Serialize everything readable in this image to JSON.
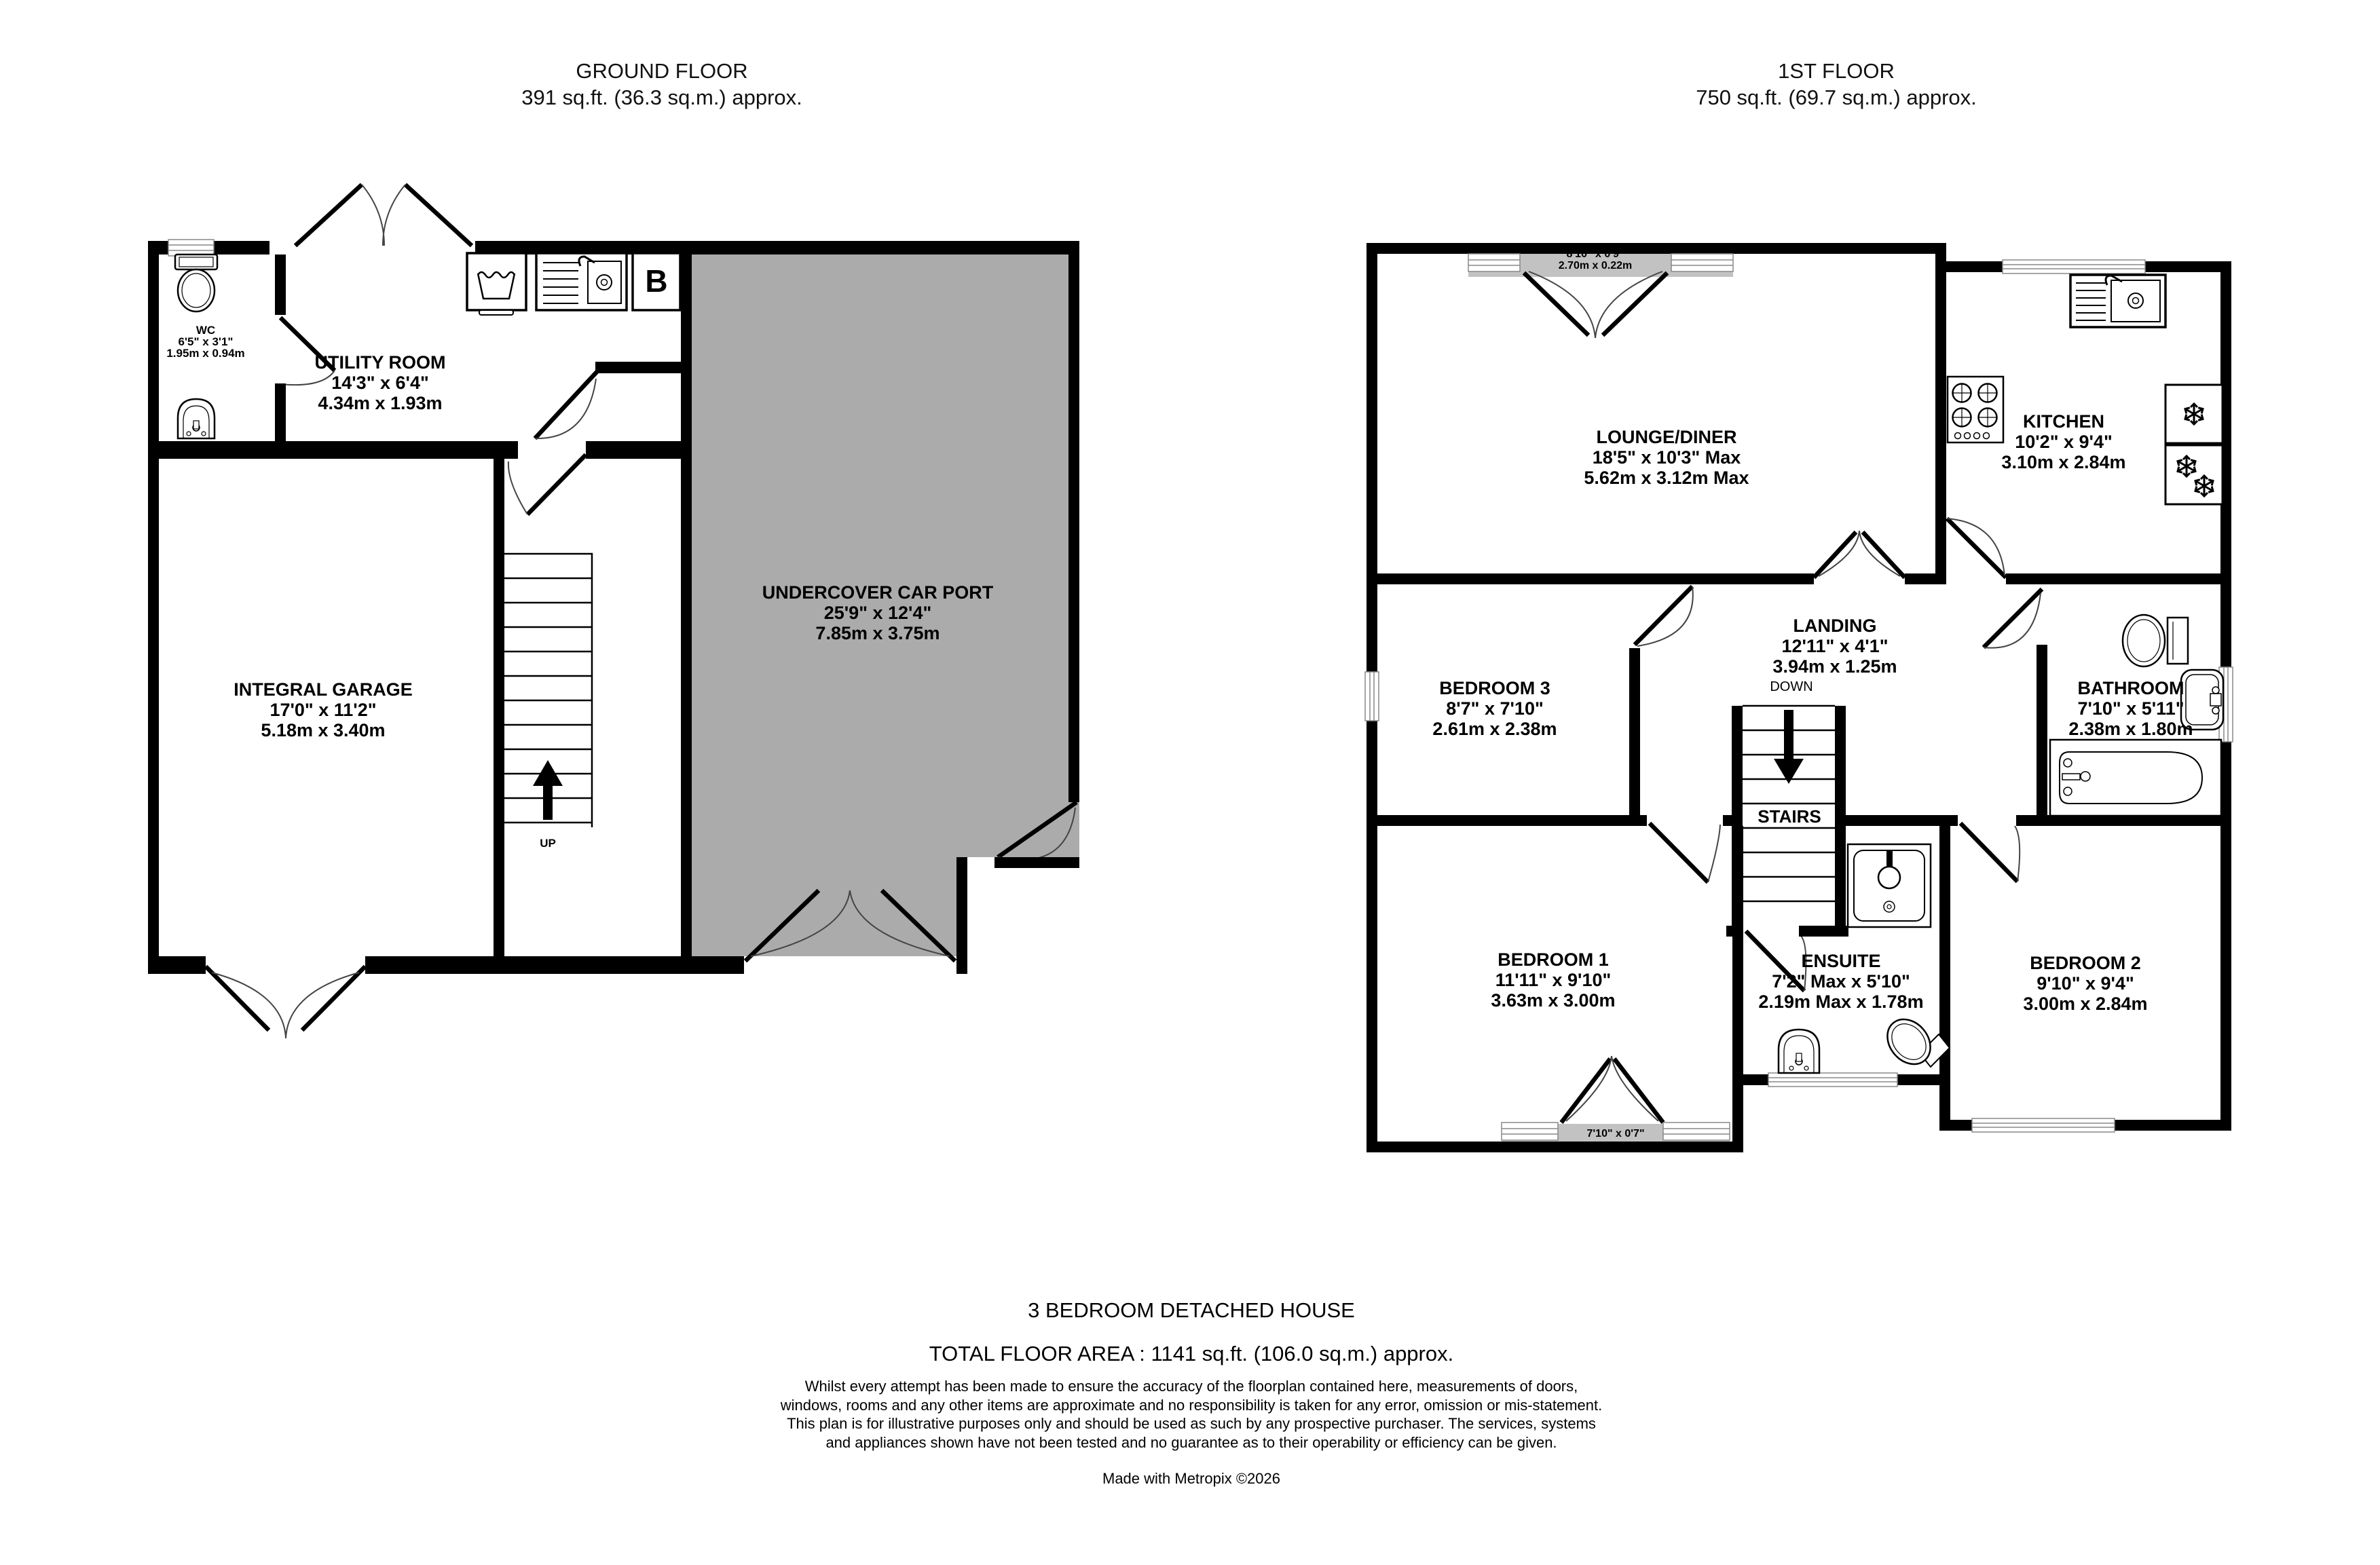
{
  "ground_floor": {
    "title": "GROUND FLOOR",
    "area": "391 sq.ft. (36.3 sq.m.) approx.",
    "rooms": {
      "wc": {
        "name": "WC",
        "imperial": "6'5\" x 3'1\"",
        "metric": "1.95m x 0.94m"
      },
      "utility": {
        "name": "UTILITY ROOM",
        "imperial": "14'3\" x 6'4\"",
        "metric": "4.34m x 1.93m"
      },
      "garage": {
        "name": "INTEGRAL GARAGE",
        "imperial": "17'0\" x 11'2\"",
        "metric": "5.18m x 3.40m"
      },
      "carport": {
        "name": "UNDERCOVER CAR PORT",
        "imperial": "25'9\" x 12'4\"",
        "metric": "7.85m x 3.75m"
      }
    },
    "labels": {
      "up": "UP",
      "boiler": "B"
    }
  },
  "first_floor": {
    "title": "1ST FLOOR",
    "area": "750 sq.ft. (69.7 sq.m.) approx.",
    "rooms": {
      "lounge": {
        "name": "LOUNGE/DINER",
        "imperial": "18'5\" x 10'3\" Max",
        "metric": "5.62m x 3.12m Max"
      },
      "kitchen": {
        "name": "KITCHEN",
        "imperial": "10'2\" x 9'4\"",
        "metric": "3.10m x 2.84m"
      },
      "landing": {
        "name": "LANDING",
        "imperial": "12'11\" x 4'1\"",
        "metric": "3.94m x 1.25m"
      },
      "bedroom3": {
        "name": "BEDROOM 3",
        "imperial": "8'7\" x 7'10\"",
        "metric": "2.61m x 2.38m"
      },
      "bathroom": {
        "name": "BATHROOM",
        "imperial": "7'10\" x 5'11\"",
        "metric": "2.38m x 1.80m"
      },
      "bedroom1": {
        "name": "BEDROOM 1",
        "imperial": "11'11\" x 9'10\"",
        "metric": "3.63m x 3.00m"
      },
      "ensuite": {
        "name": "ENSUITE",
        "imperial": "7'2\" Max x 5'10\"",
        "metric": "2.19m Max x 1.78m"
      },
      "bedroom2": {
        "name": "BEDROOM 2",
        "imperial": "9'10\" x 9'4\"",
        "metric": "3.00m x 2.84m"
      }
    },
    "labels": {
      "down": "DOWN",
      "stairs": "STAIRS"
    },
    "windows": {
      "lounge_bay": {
        "imperial": "8'10\" x 0'9\"",
        "metric": "2.70m x 0.22m"
      },
      "bedroom1_balcony": {
        "imperial": "7'10\" x 0'7\""
      }
    }
  },
  "footer": {
    "property_type": "3 BEDROOM DETACHED HOUSE",
    "total_area": "TOTAL FLOOR AREA : 1141 sq.ft. (106.0 sq.m.) approx.",
    "disclaimer": "Whilst every attempt has been made to ensure the accuracy of the floorplan contained here, measurements of doors, windows, rooms and any other items are approximate and no responsibility is taken for any error, omission or mis-statement. This plan is for illustrative purposes only and should be used as such by any prospective purchaser. The services, systems and appliances shown have not been tested and no guarantee as to their operability or efficiency can be given.",
    "credit": "Made with Metropix ©2026"
  },
  "colors": {
    "wall": "#000000",
    "carport_fill": "#ababab",
    "bay_fill": "#c2c2c2",
    "background": "#ffffff"
  }
}
